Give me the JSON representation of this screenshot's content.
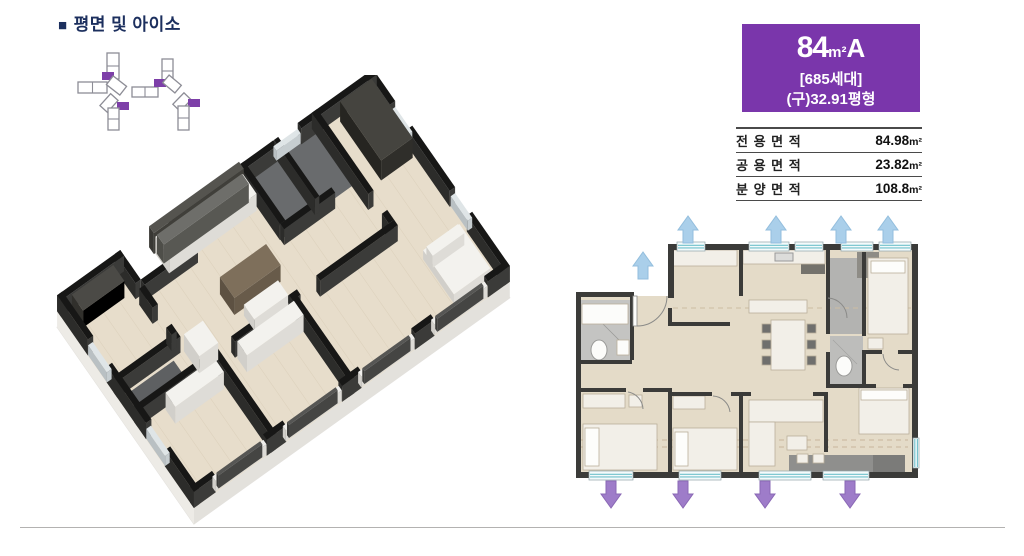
{
  "header": {
    "bullet": "■",
    "title": "평면 및 아이소"
  },
  "unit_badge": {
    "size_number": "84",
    "size_unit": "m²",
    "size_type": "A",
    "households": "[685세대]",
    "legacy_size": "(구)32.91평형",
    "bg_color": "#7a36ab"
  },
  "area_table": {
    "rows": [
      {
        "label": "전 용 면 적",
        "value": "84.98",
        "unit": "m²"
      },
      {
        "label": "공 용 면 적",
        "value": "23.82",
        "unit": "m²"
      },
      {
        "label": "분 양 면 적",
        "value": "108.8",
        "unit": "m²"
      }
    ]
  },
  "site_map": {
    "marker_color": "#7d3fa8",
    "building_stroke": "#8d8d96"
  },
  "floor_plan_3d": {
    "label": "84A 3D isometric floor plan"
  },
  "floor_plan_2d": {
    "label": "84A 2D floor plan",
    "up_arrow_color": "#aacfea",
    "down_arrow_color": "#9e7cc9",
    "up_arrows": 5,
    "down_arrows": 4
  }
}
